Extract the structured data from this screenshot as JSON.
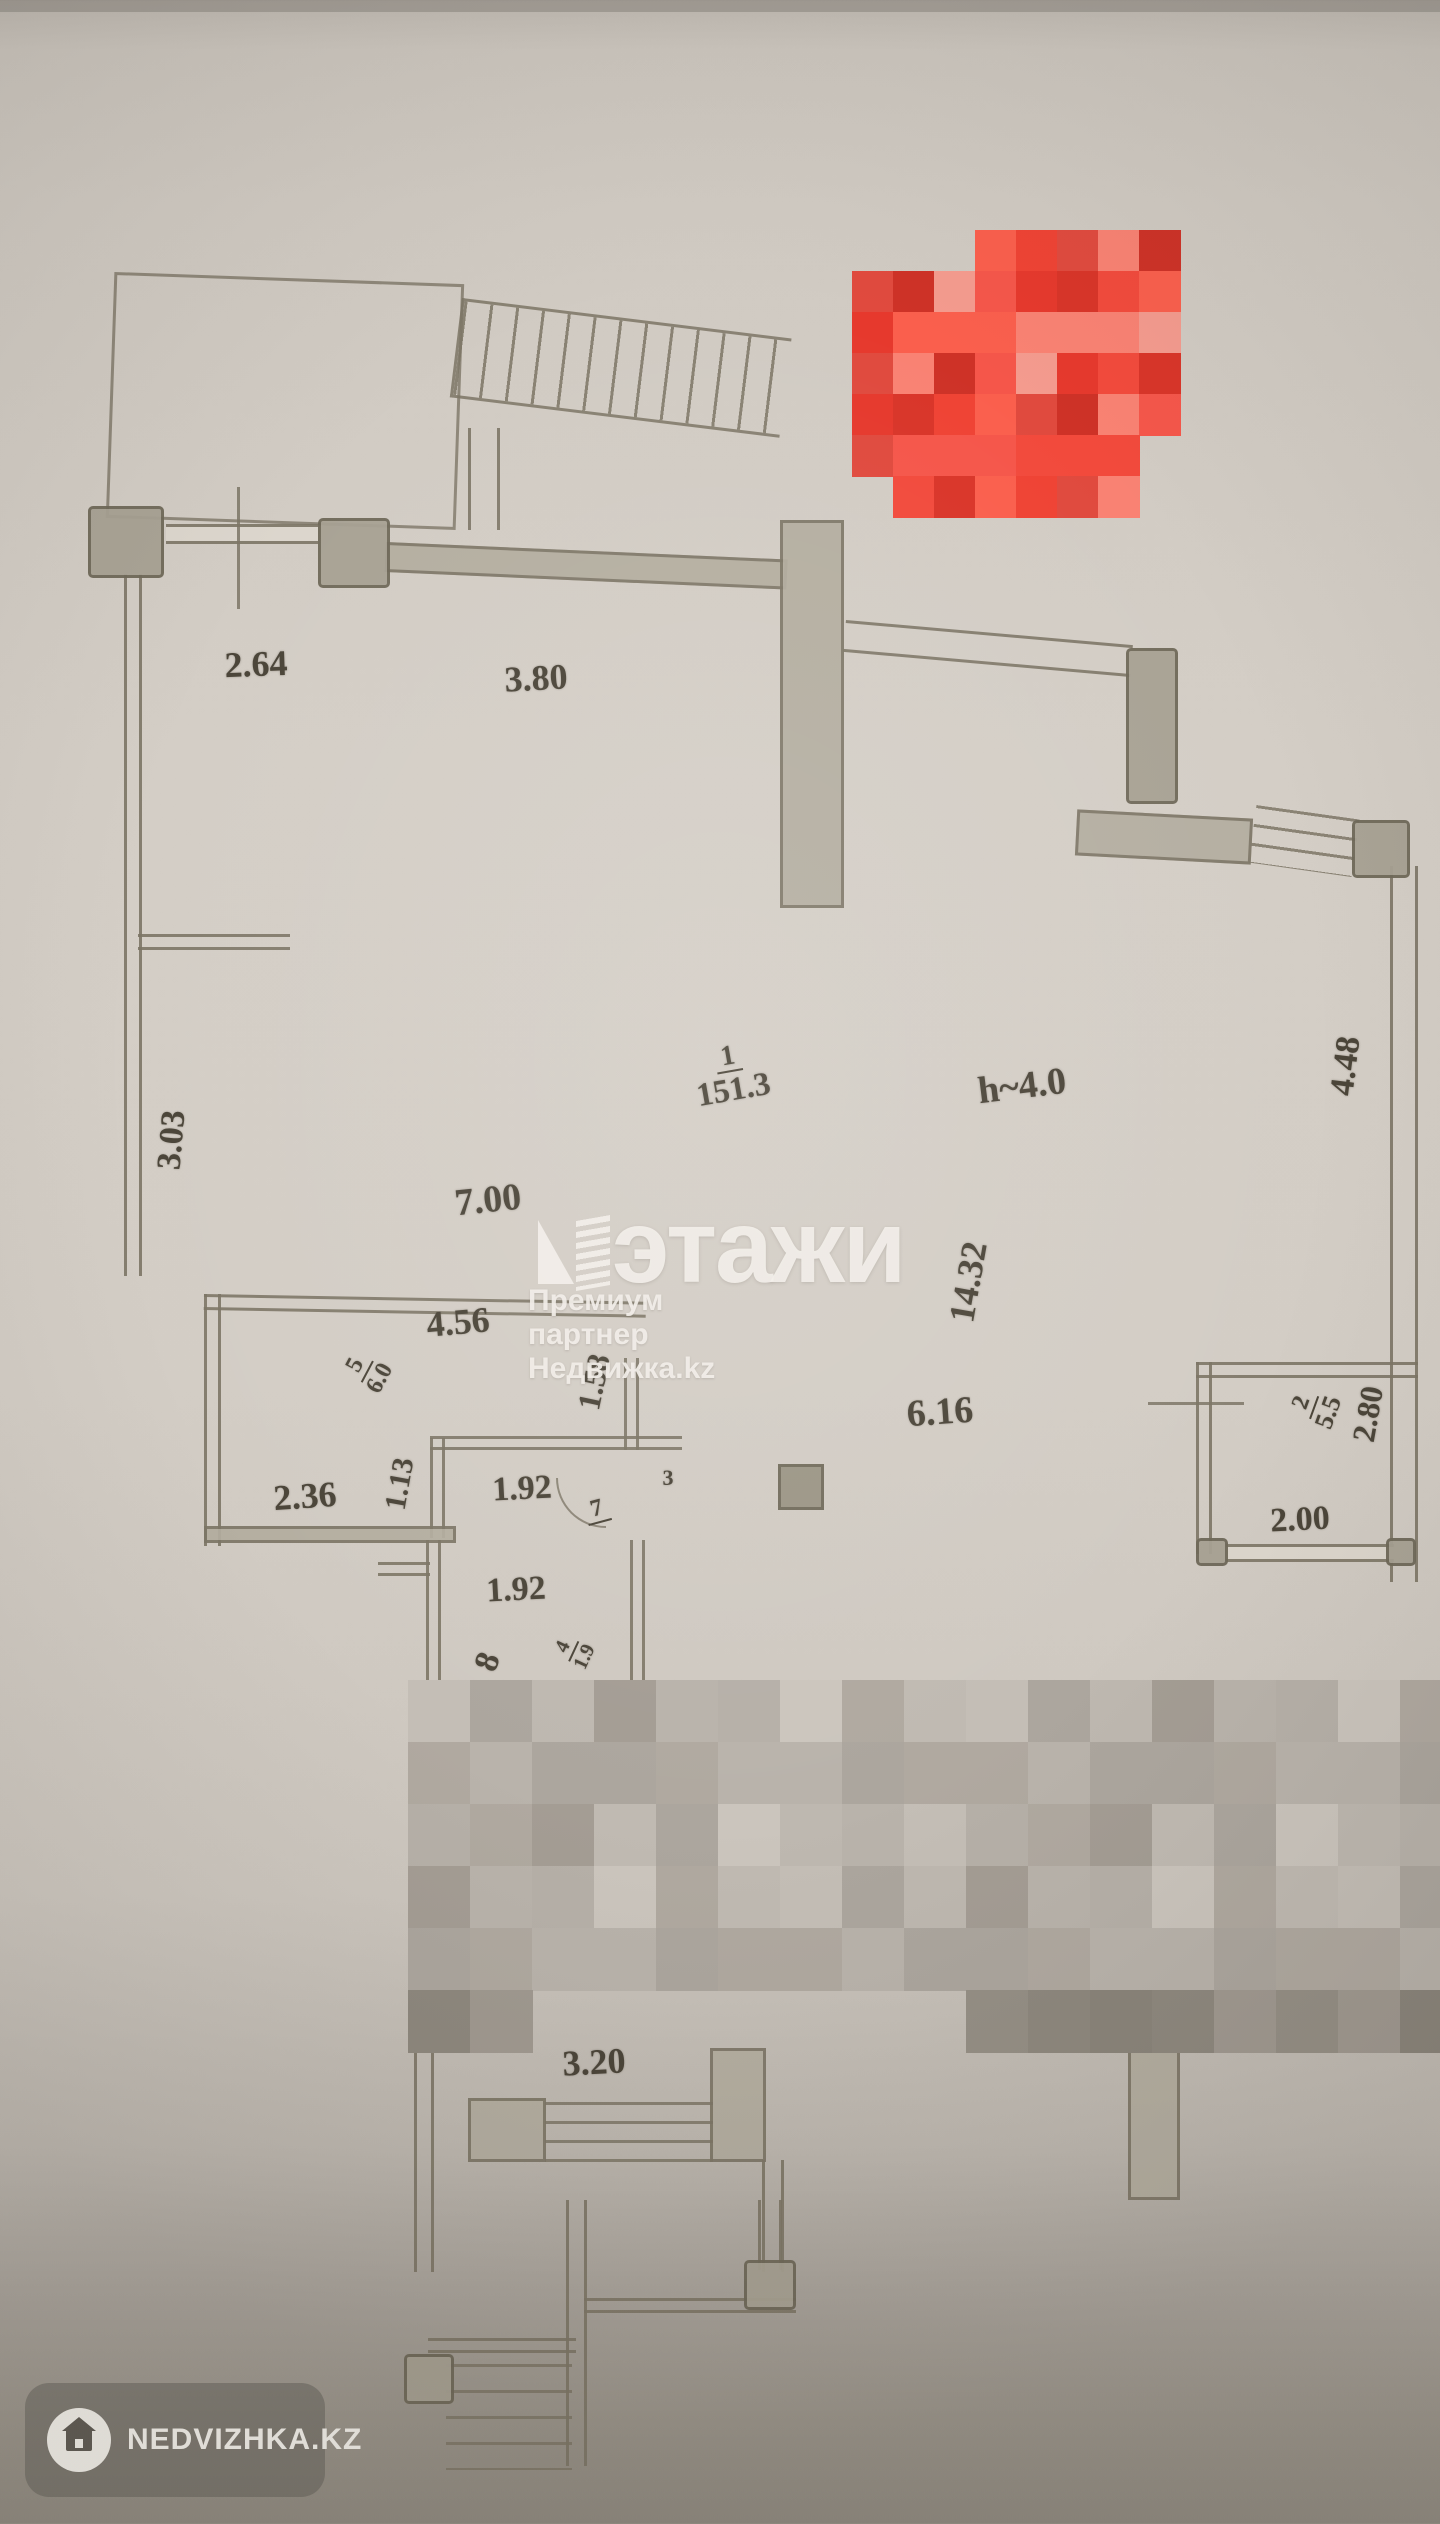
{
  "meta": {
    "width": 1440,
    "height": 2524,
    "kind": "scanned floor plan photo"
  },
  "colors": {
    "paper": "#d3cdc5",
    "paper_bottom": "#8f897f",
    "line": "#7d7666",
    "wall_fill": "#b3ad9f",
    "pier_fill": "#a7a193",
    "text": "#4b4539",
    "watermark": "rgba(242,238,232,0.92)",
    "badge_bg": "rgba(92,88,82,0.45)"
  },
  "watermark": {
    "title": "этажи",
    "subtitle": "Премиум партнер Недвижка.kz",
    "icon": "etazhi-building-icon"
  },
  "badge": {
    "label": "NEDVIZHKA.KZ",
    "icon": "house-icon"
  },
  "plan": {
    "height_note": "h~4.0",
    "dimensions": [
      {
        "text": "2.64",
        "x": 256,
        "y": 664,
        "rot": -2,
        "size": 36
      },
      {
        "text": "3.80",
        "x": 536,
        "y": 678,
        "rot": -3,
        "size": 36
      },
      {
        "text": "3.03",
        "x": 172,
        "y": 1140,
        "rot": -85,
        "size": 34
      },
      {
        "text": "7.00",
        "x": 488,
        "y": 1200,
        "rot": -6,
        "size": 38
      },
      {
        "text": "h~4.0",
        "x": 1022,
        "y": 1086,
        "rot": -7,
        "size": 38
      },
      {
        "text": "4.48",
        "x": 1346,
        "y": 1066,
        "rot": -83,
        "size": 34
      },
      {
        "text": "14.32",
        "x": 968,
        "y": 1282,
        "rot": -80,
        "size": 36
      },
      {
        "text": "4.56",
        "x": 458,
        "y": 1322,
        "rot": -5,
        "size": 36
      },
      {
        "text": "1.58",
        "x": 594,
        "y": 1382,
        "rot": -78,
        "size": 32
      },
      {
        "text": "2.36",
        "x": 305,
        "y": 1496,
        "rot": -4,
        "size": 36
      },
      {
        "text": "1.13",
        "x": 400,
        "y": 1484,
        "rot": -80,
        "size": 30
      },
      {
        "text": "1.92",
        "x": 522,
        "y": 1489,
        "rot": -3,
        "size": 34
      },
      {
        "text": "3",
        "x": 668,
        "y": 1478,
        "rot": 0,
        "size": 22
      },
      {
        "text": "6.16",
        "x": 940,
        "y": 1412,
        "rot": -4,
        "size": 38
      },
      {
        "text": "2.80",
        "x": 1368,
        "y": 1414,
        "rot": -80,
        "size": 32
      },
      {
        "text": "2.00",
        "x": 1300,
        "y": 1520,
        "rot": -3,
        "size": 34
      },
      {
        "text": "1.92",
        "x": 516,
        "y": 1590,
        "rot": -3,
        "size": 34
      },
      {
        "text": "8",
        "x": 488,
        "y": 1662,
        "rot": -70,
        "size": 34
      },
      {
        "text": "3.20",
        "x": 594,
        "y": 2062,
        "rot": -3,
        "size": 36
      }
    ],
    "rooms": [
      {
        "number": "1",
        "area": "151.3",
        "x": 731,
        "y": 1075,
        "rot": -10,
        "numSize": 28,
        "areaSize": 33
      },
      {
        "number": "5",
        "area": "6.0",
        "x": 368,
        "y": 1372,
        "rot": -62,
        "numSize": 24,
        "areaSize": 24
      },
      {
        "number": "7",
        "area": "",
        "x": 597,
        "y": 1510,
        "rot": -15,
        "numSize": 24,
        "areaSize": 0
      },
      {
        "number": "2",
        "area": "5.5",
        "x": 1316,
        "y": 1408,
        "rot": -70,
        "numSize": 24,
        "areaSize": 26
      },
      {
        "number": "4",
        "area": "1.9",
        "x": 574,
        "y": 1652,
        "rot": -65,
        "numSize": 20,
        "areaSize": 20
      }
    ]
  },
  "mosaics": {
    "red": {
      "x": 852,
      "y": 230,
      "cell": 41,
      "palette": [
        "#e6392d",
        "#f24a3c",
        "#d93529",
        "#fa5f4d",
        "#ef4334",
        "#e04a3e",
        "#f98273",
        "#ce3227",
        "#f5564a",
        "#f49b8e"
      ],
      "rows": [
        {
          "segs": [
            [
              3,
              8
            ]
          ]
        },
        {
          "segs": [
            [
              0,
              8
            ]
          ]
        },
        {
          "segs": [
            [
              0,
              8
            ]
          ]
        },
        {
          "segs": [
            [
              0,
              8
            ]
          ]
        },
        {
          "segs": [
            [
              0,
              8
            ]
          ]
        },
        {
          "segs": [
            [
              0,
              7
            ]
          ]
        },
        {
          "segs": [
            [
              1,
              7
            ]
          ]
        }
      ]
    },
    "gray": {
      "x": 408,
      "y": 1680,
      "cell": 62,
      "palette": [
        "#c4beb6",
        "#b6b0a8",
        "#aca69e",
        "#cbc5bd",
        "#beb8b0",
        "#b0a9a0",
        "#a49d94",
        "#c0bab2",
        "#b9b3ab"
      ],
      "dark_palette": [
        "#958f85",
        "#8e887e",
        "#a09990",
        "#8a847a"
      ],
      "rows": [
        {
          "segs": [
            [
              0,
              17
            ]
          ]
        },
        {
          "segs": [
            [
              0,
              17
            ]
          ]
        },
        {
          "segs": [
            [
              0,
              17
            ]
          ]
        },
        {
          "segs": [
            [
              0,
              17
            ]
          ]
        },
        {
          "segs": [
            [
              0,
              17
            ]
          ]
        },
        {
          "segs": [
            [
              0,
              2
            ],
            [
              9,
              17
            ]
          ],
          "dark": true
        }
      ]
    }
  }
}
